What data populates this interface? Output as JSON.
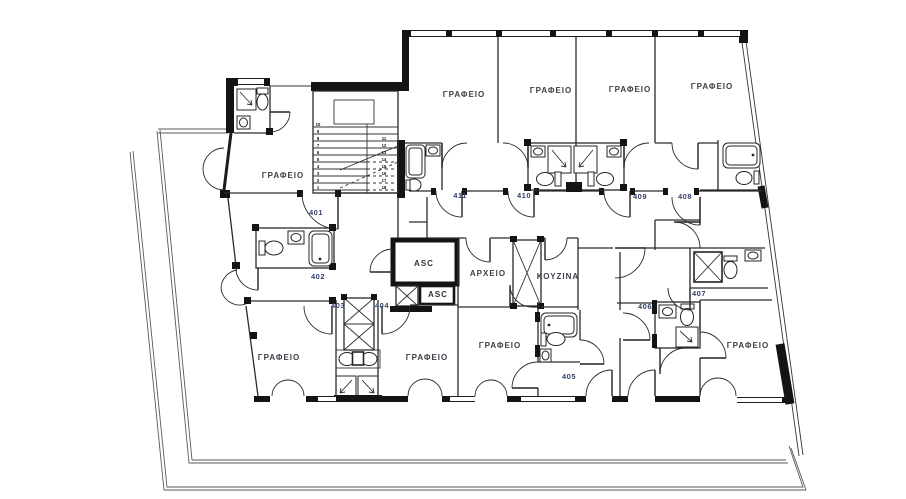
{
  "document": {
    "type": "architectural-floor-plan",
    "language": "Greek",
    "room_number_range": "401 - 411"
  },
  "legend": {
    "office_label": "ΓΡΑΦΕΙΟ",
    "archive_label": "ΑΡΧΕΙΟ",
    "kitchen_label": "ΚΟΥΖΙΝΑ",
    "elevator_label": "ASC"
  },
  "plan": {
    "labels": [
      {
        "id": "office-411-name",
        "text": "ΓΡΑΦΕΙΟ",
        "x": 464,
        "y": 97,
        "cls": "room"
      },
      {
        "id": "office-410-name",
        "text": "ΓΡΑΦΕΙΟ",
        "x": 551,
        "y": 93,
        "cls": "room"
      },
      {
        "id": "office-409-name",
        "text": "ΓΡΑΦΕΙΟ",
        "x": 630,
        "y": 92,
        "cls": "room"
      },
      {
        "id": "office-408-name",
        "text": "ΓΡΑΦΕΙΟ",
        "x": 712,
        "y": 89,
        "cls": "room"
      },
      {
        "id": "office-401-name",
        "text": "ΓΡΑΦΕΙΟ",
        "x": 283,
        "y": 178,
        "cls": "room"
      },
      {
        "id": "room-401-number",
        "text": "401",
        "x": 316,
        "y": 215,
        "cls": "num"
      },
      {
        "id": "room-402-number",
        "text": "402",
        "x": 318,
        "y": 279,
        "cls": "num"
      },
      {
        "id": "room-403-number",
        "text": "403",
        "x": 338,
        "y": 308,
        "cls": "num"
      },
      {
        "id": "room-404-number",
        "text": "404",
        "x": 382,
        "y": 308,
        "cls": "num"
      },
      {
        "id": "room-411-number",
        "text": "411",
        "x": 460,
        "y": 198,
        "cls": "num"
      },
      {
        "id": "room-410-number",
        "text": "410",
        "x": 524,
        "y": 198,
        "cls": "num"
      },
      {
        "id": "room-409-number",
        "text": "409",
        "x": 640,
        "y": 199,
        "cls": "num"
      },
      {
        "id": "room-408-number",
        "text": "408",
        "x": 685,
        "y": 199,
        "cls": "num"
      },
      {
        "id": "asc-main-label",
        "text": "ASC",
        "x": 424,
        "y": 266,
        "cls": "asc"
      },
      {
        "id": "asc-small-label",
        "text": "ASC",
        "x": 438,
        "y": 297,
        "cls": "asc"
      },
      {
        "id": "archive-name",
        "text": "ΑΡΧΕΙΟ",
        "x": 488,
        "y": 276,
        "cls": "room"
      },
      {
        "id": "kitchen-name",
        "text": "ΚΟΥΖΙΝΑ",
        "x": 558,
        "y": 279,
        "cls": "room"
      },
      {
        "id": "office-bl1-name",
        "text": "ΓΡΑΦΕΙΟ",
        "x": 279,
        "y": 360,
        "cls": "room"
      },
      {
        "id": "office-bl2-name",
        "text": "ΓΡΑΦΕΙΟ",
        "x": 427,
        "y": 360,
        "cls": "room"
      },
      {
        "id": "office-bm-name",
        "text": "ΓΡΑΦΕΙΟ",
        "x": 500,
        "y": 348,
        "cls": "room"
      },
      {
        "id": "room-405-number",
        "text": "405",
        "x": 569,
        "y": 379,
        "cls": "num"
      },
      {
        "id": "room-406-number",
        "text": "406",
        "x": 645,
        "y": 309,
        "cls": "num"
      },
      {
        "id": "room-407-number",
        "text": "407",
        "x": 699,
        "y": 296,
        "cls": "num"
      },
      {
        "id": "office-br-name",
        "text": "ΓΡΑΦΕΙΟ",
        "x": 748,
        "y": 348,
        "cls": "room"
      }
    ],
    "staircase": {
      "left_step_numbers": [
        "10",
        "9",
        "8",
        "7",
        "6",
        "5",
        "4",
        "3",
        "2",
        "1"
      ],
      "right_step_numbers": [
        "11",
        "12",
        "13",
        "14",
        "15",
        "16",
        "17",
        "18"
      ]
    },
    "colors": {
      "wall": "#141414",
      "room_name_text": "#3c4046",
      "room_number_text": "#35406b",
      "background": "#ffffff"
    }
  }
}
